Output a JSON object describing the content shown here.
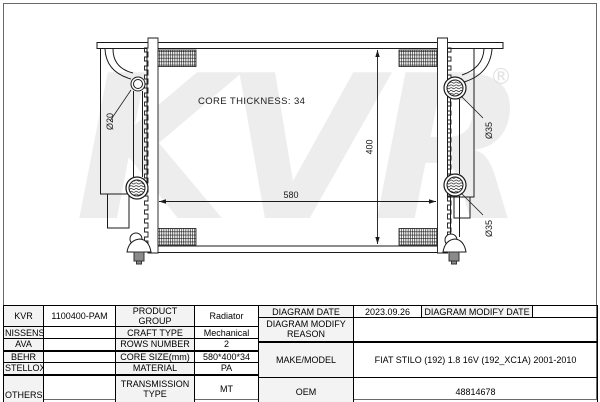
{
  "diagram": {
    "watermark": "KVR",
    "registered_mark": "®",
    "core_thickness_note": "CORE THICKNESS: 34",
    "width_dimension": "580",
    "height_dimension": "400",
    "left_port_diameter": "Ø20",
    "right_top_port_diameter": "Ø35",
    "right_bottom_port_diameter": "Ø35"
  },
  "table": {
    "brands": {
      "b1": "KVR",
      "b2": "NISSENS",
      "b3": "AVA",
      "b4": "BEHR",
      "b5": "STELLOX",
      "b6": "OTHERS"
    },
    "part_number": "1100400-PAM",
    "left": {
      "product_group_label": "PRODUCT GROUP",
      "product_group_value": "Radiator",
      "craft_type_label": "CRAFT TYPE",
      "craft_type_value": "Mechanical",
      "rows_number_label": "ROWS NUMBER",
      "rows_number_value": "2",
      "core_size_label": "CORE SIZE(mm)",
      "core_size_value": "580*400*34",
      "material_label": "MATERIAL",
      "material_value": "PA",
      "transmission_type_label": "TRANSMISSION TYPE",
      "transmission_type_value": "MT",
      "supplementary_label": "SUPPLEMENTARY"
    },
    "right": {
      "diagram_date_label": "DIAGRAM DATE",
      "diagram_date_value": "2023.09.26",
      "diagram_modify_date_label": "DIAGRAM MODIFY DATE",
      "diagram_modify_reason_label": "DIAGRAM MODIFY REASON",
      "make_model_label": "MAKE/MODEL",
      "make_model_value": "FIAT STILO (192) 1.8 16V (192_XC1A) 2001-2010",
      "oem_label": "OEM",
      "oem_value": "48814678"
    }
  }
}
